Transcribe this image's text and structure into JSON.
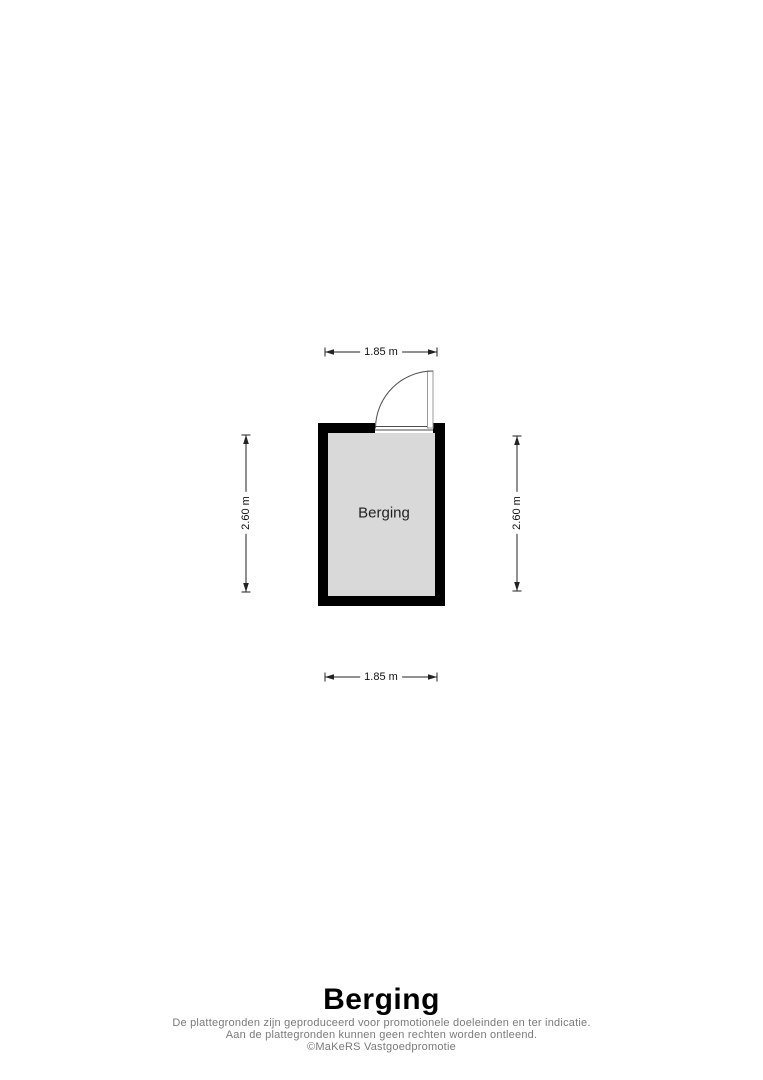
{
  "plan": {
    "room_label": "Berging",
    "dimensions": {
      "top": "1.85 m",
      "bottom": "1.85 m",
      "left": "2.60 m",
      "right": "2.60 m"
    }
  },
  "footer": {
    "title": "Berging",
    "disclaimer": [
      "De plattegronden zijn geproduceerd voor promotionele doeleinden en ter indicatie.",
      "Aan de plattegronden kunnen geen rechten worden ontleend.",
      "©MaKeRS Vastgoedpromotie"
    ]
  },
  "colors": {
    "background": "#ffffff",
    "wall": "#000000",
    "room_fill": "#d9d9d9",
    "dimension_line": "#222222",
    "dimension_text": "#111111",
    "room_label_text": "#1f1f1f",
    "title_text": "#000000",
    "disclaimer_text": "#7a7a7a",
    "door_line": "#4d4d4d"
  }
}
